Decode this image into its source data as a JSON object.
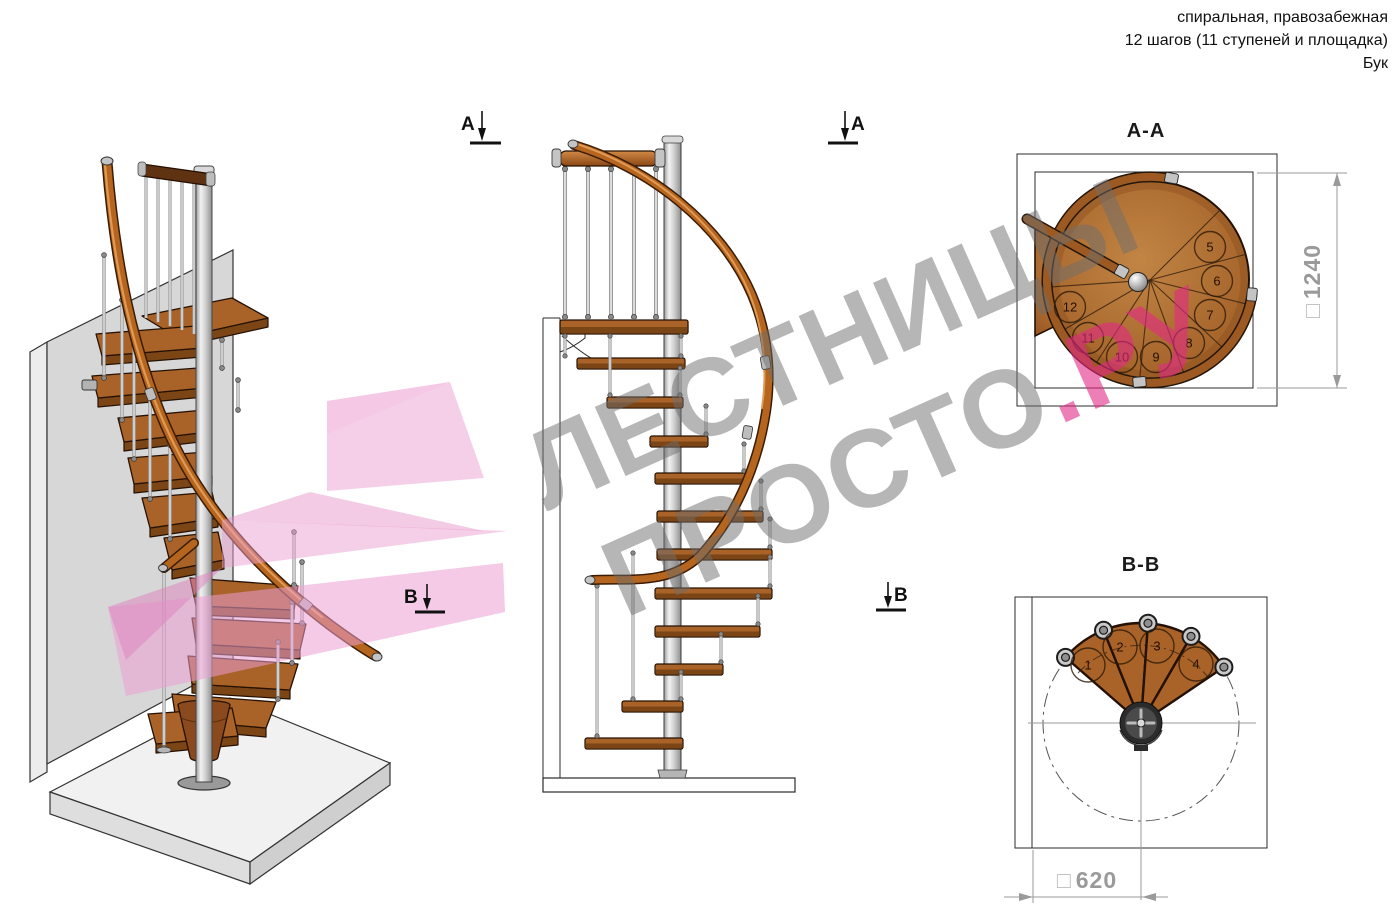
{
  "header": {
    "line1": "спиральная, правозабежная",
    "line2": "12 шагов (11 ступеней и площадка)",
    "line3": "Бук"
  },
  "watermark": {
    "line1": "ЛЕСТНИЦЫ",
    "line2_gray": "ПРОСТО",
    "line2_pink": ".РУ"
  },
  "sections": {
    "aa": {
      "title": "A-A",
      "dimension_prefix": "□",
      "dimension_value": "1240",
      "step_numbers": [
        5,
        6,
        7,
        8,
        9,
        10,
        11,
        12
      ]
    },
    "bb": {
      "title": "B-B",
      "dimension_prefix": "□",
      "dimension_value": "620",
      "step_numbers": [
        1,
        2,
        3,
        4
      ]
    }
  },
  "markers": {
    "a": "A",
    "b": "B"
  },
  "colors": {
    "wood_top": "#a96328",
    "wood_dark": "#7c4515",
    "handrail": "#b5651d",
    "metal": "#c7c7c7",
    "watermark_gray": "#a7a7a7",
    "accent_pink": "#ee7ab0",
    "dimension_gray": "#9a9a9a"
  }
}
